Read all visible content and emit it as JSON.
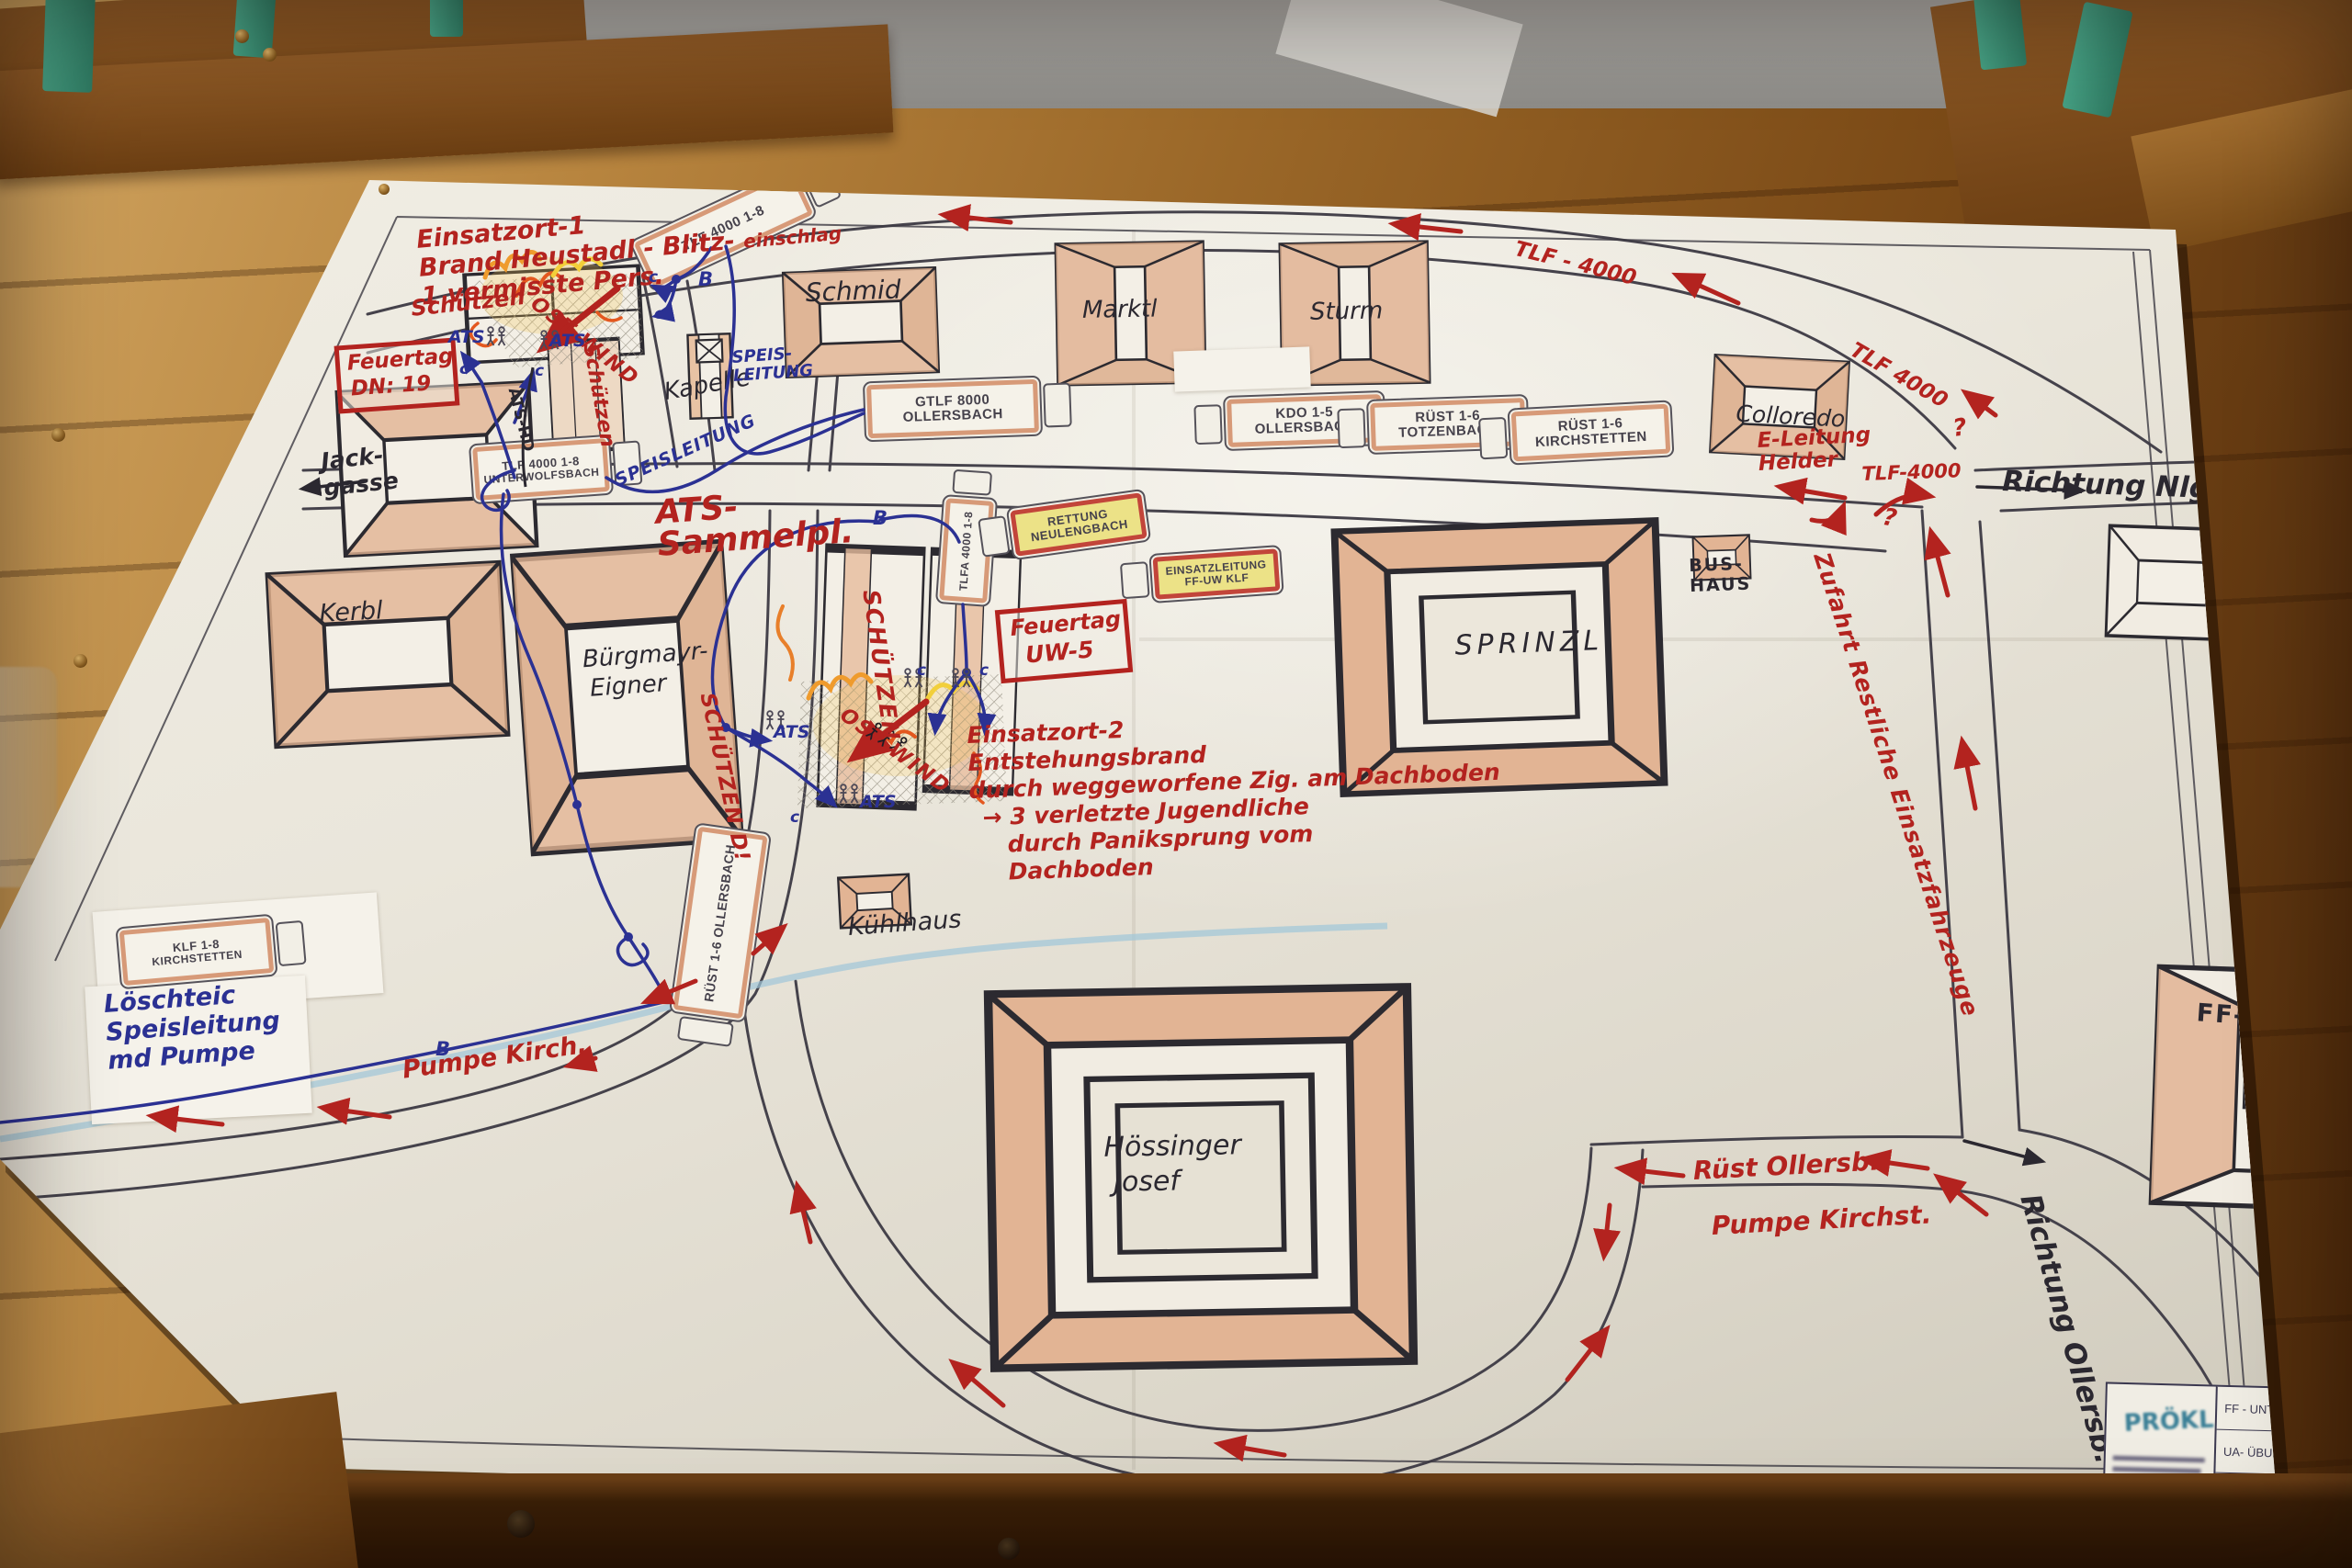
{
  "scene": {
    "colors": {
      "marker_red": "#b3231f",
      "pen_blue": "#2b3193",
      "ink_black": "#2b2830",
      "roof_salmon": "#ddab8a",
      "paper": "#eae6db",
      "wood": "#8a5a24",
      "rail_green": "#3b8e74",
      "highlight_yellow": "#ece287",
      "road_gray": "#45424b",
      "stream_blue": "#9fc6d8"
    }
  },
  "incident1": {
    "l1": "Einsatzort-1",
    "l2": "Brand Heustadl - Blitz-",
    "l2b": "einschlag",
    "l3": "1 vermisste Pers."
  },
  "incident2": {
    "l1": "Einsatzort-2",
    "l2": "Entstehungsbrand",
    "l3": "durch weggeworfene Zig. am Dachboden",
    "l4": "→ 3 verletzte Jugendliche",
    "l5": "durch Paniksprung vom",
    "l6": "Dachboden"
  },
  "boxes": {
    "feuertag1_l1": "Feuertag",
    "feuertag1_l2": "DN: 19",
    "feuertag2_l1": "Feuertag",
    "feuertag2_l2": "UW-5"
  },
  "buildings": {
    "schmid": "Schmid",
    "marktl": "Marktl",
    "sturm": "Sturm",
    "kapelle": "Kapelle",
    "colloredo": "Colloredo",
    "kerbl": "Kerbl",
    "buergmayr_l1": "Bürgmayr-",
    "buergmayr_l2": "Eigner",
    "sprinzl": "SPRINZL",
    "bushaus_l1": "BUS-",
    "bushaus_l2": "HAUS",
    "kuehlhaus": "Kühlhaus",
    "hoessinger_l1": "Hössinger",
    "hoessinger_l2": "Josef",
    "ffhaus": "FF-HAUS",
    "schuetzen": "Schützen",
    "schuetzen_caps": "SCHÜTZEN",
    "schuetzen_d": "SCHÜTZEN D!"
  },
  "trucks": [
    {
      "l1": "TLF 4000  1-8",
      "l2": ""
    },
    {
      "l1": "GTLF 8000",
      "l2": "OLLERSBACH"
    },
    {
      "l1": "KDO  1-5",
      "l2": "OLLERSBACH"
    },
    {
      "l1": "RÜST 1-6",
      "l2": "TOTZENBACH"
    },
    {
      "l1": "RÜST 1-6",
      "l2": "KIRCHSTETTEN"
    },
    {
      "l1": "TLF 4000  1-8",
      "l2": "UNTERWOLFSBACH"
    },
    {
      "l1": "TLFA 4000  1-8",
      "l2": ""
    },
    {
      "l1": "RETTUNG",
      "l2": "NEULENGBACH"
    },
    {
      "l1": "EINSATZLEITUNG",
      "l2": "FF-UW  KLF"
    },
    {
      "l1": "RÜST 1-6",
      "l2": "OLLERSBACH"
    },
    {
      "l1": "KLF  1-8",
      "l2": "KIRCHSTETTEN"
    }
  ],
  "roads": {
    "richtung_nlgb": "Richtung Nlgb.",
    "richtung_ollersb": "Richtung Ollersb.",
    "jack_l1": "Jack-",
    "jack_l2": "gasse",
    "zufahrt": "Zufahrt Restliche Einsatzfahrzeuge",
    "tlf4000_a": "TLF - 4000",
    "tlf4000_b": "TLF 4000",
    "tlf4000_c": "TLF-4000",
    "ruest_ollersb": "Rüst Ollersb.",
    "pumpe_kirchst": "Pumpe Kirchst.",
    "pumpe_kirch": "Pumpe Kirch.",
    "eleitung_l1": "E-Leitung",
    "eleitung_l2": "Helder",
    "ostwind": "OST WIND",
    "qmark": "?"
  },
  "water": {
    "ats_sammelpl_l1": "ATS-",
    "ats_sammelpl_l2": "Sammelpl.",
    "speis_l1": "SPEIS-",
    "speis_l2": "LEITUNG",
    "speisleitung": "SPEISLEITUNG",
    "ats": "ATS",
    "ats_hd": "ATS-HD",
    "b": "B",
    "c": "c",
    "loesch_l1": "Löschteic",
    "loesch_l2": "Speisleitung",
    "loesch_l3": "md Pumpe"
  },
  "titleblock": {
    "stamp": "PRÖKL",
    "row1": "FF - UNTERWO…",
    "row2": "UA- ÜBUNG…"
  }
}
